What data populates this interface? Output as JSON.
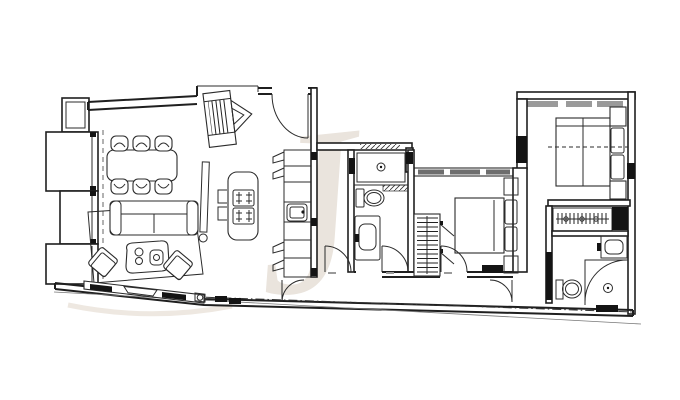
{
  "document": {
    "type": "architectural-floor-plan",
    "background": "#ffffff"
  },
  "colors": {
    "wall_line": "#1f1f1f",
    "furniture_line": "#2b2b2b",
    "black_fill": "#141414",
    "window_gray": "#6e6e6e",
    "curtain_gray": "#9a9a9a",
    "watermark": "#eae4dd",
    "dimension_gray": "#9a9a9a"
  },
  "watermark": {
    "glyph": "J"
  },
  "rooms": [
    {
      "name": "living-dining-area",
      "furniture": [
        "dining-table",
        "dining-chairs-x6",
        "sofa",
        "rug",
        "coffee-table",
        "armchair-x2",
        "media-console",
        "radiator"
      ]
    },
    {
      "name": "kitchen",
      "furniture": [
        "island-with-cooktop",
        "bar-stools-x2",
        "cabinet-run",
        "kitchen-sink"
      ]
    },
    {
      "name": "entrance-vestibule",
      "furniture": [
        "coat-closet",
        "entrance-door"
      ]
    },
    {
      "name": "bathroom-1",
      "furniture": [
        "shower",
        "toilet",
        "vanity-sink"
      ]
    },
    {
      "name": "hallway",
      "furniture": [
        "swing-door-x2"
      ]
    },
    {
      "name": "bedroom-2",
      "furniture": [
        "double-bed",
        "nightstand-x2",
        "wardrobe",
        "tv"
      ]
    },
    {
      "name": "master-bedroom",
      "furniture": [
        "double-bed",
        "nightstand-x2",
        "pillows"
      ]
    },
    {
      "name": "walk-in-closet",
      "furniture": [
        "clothes-rail-with-hangers"
      ]
    },
    {
      "name": "master-bathroom",
      "furniture": [
        "shower",
        "toilet",
        "vanity-sink"
      ]
    }
  ]
}
